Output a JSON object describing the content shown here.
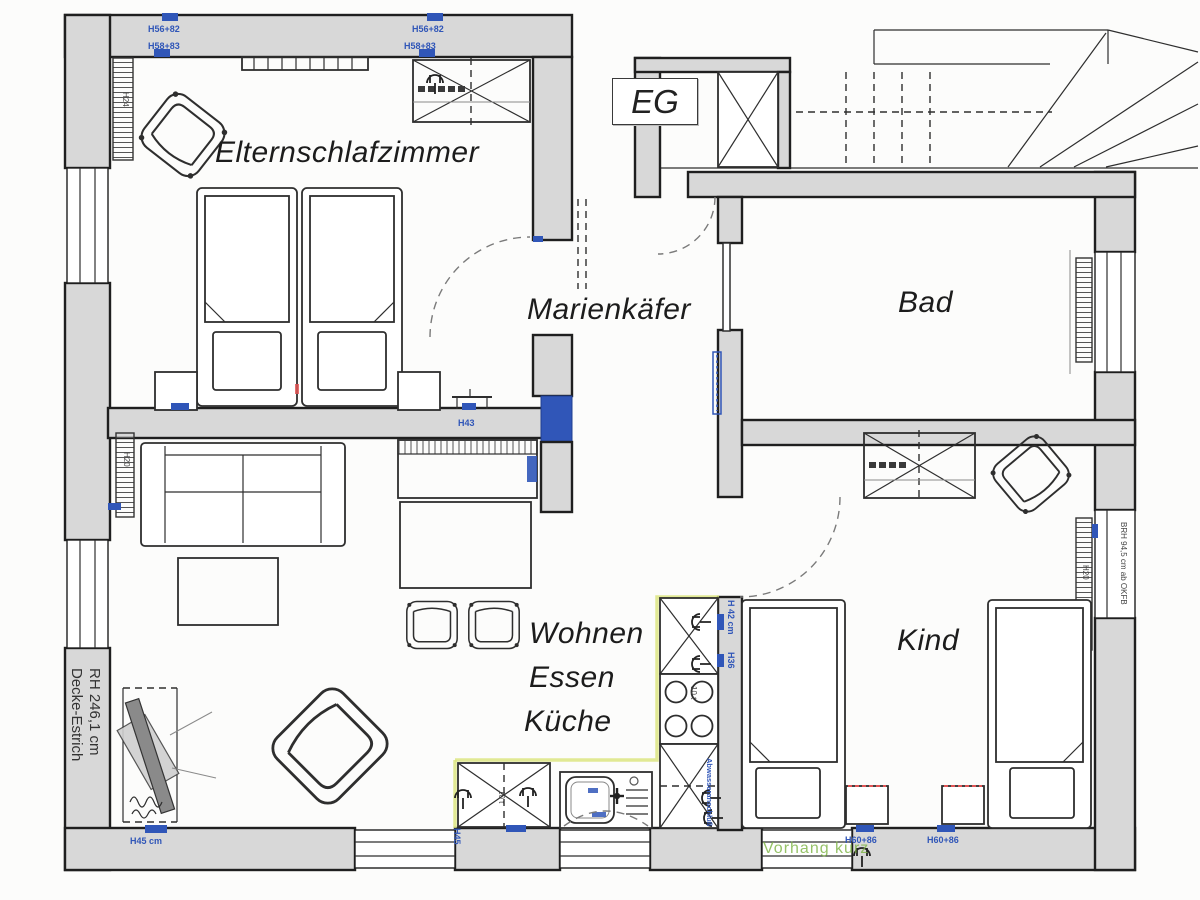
{
  "floor_label": "EG",
  "rooms": {
    "parents_bedroom": "Elternschlafzimmer",
    "hall_name": "Marienkäfer",
    "bath": "Bad",
    "living": "Wohnen",
    "dining": "Essen",
    "kitchen": "Küche",
    "child": "Kind"
  },
  "annotations": {
    "h56_82": "H56+82",
    "h58_83": "H58+83",
    "h43": "H43",
    "h45_cm": "H45 cm",
    "h45": "H45",
    "h42_cm": "H 42 cm",
    "h36": "H36",
    "h60_86": "H60+86",
    "h20": "H20",
    "h24": "H24",
    "stove_note": "10 t",
    "room_height": "RH 246,1 cm",
    "ceiling_note": "Decke-Estrich",
    "sill_height": "BRH 94,5 cm ab OKFB",
    "curtain_note": "Vorhang kurz",
    "drain_note": "Abwasseranschluß"
  },
  "colors": {
    "wall_fill": "#d8d8d8",
    "line": "#2e2e2e",
    "marker_blue": "#3056b8",
    "note_green": "#7cb342",
    "accent_red": "#e05555",
    "highlight_yellow": "#d9e37a",
    "paper": "#fcfcfb"
  }
}
